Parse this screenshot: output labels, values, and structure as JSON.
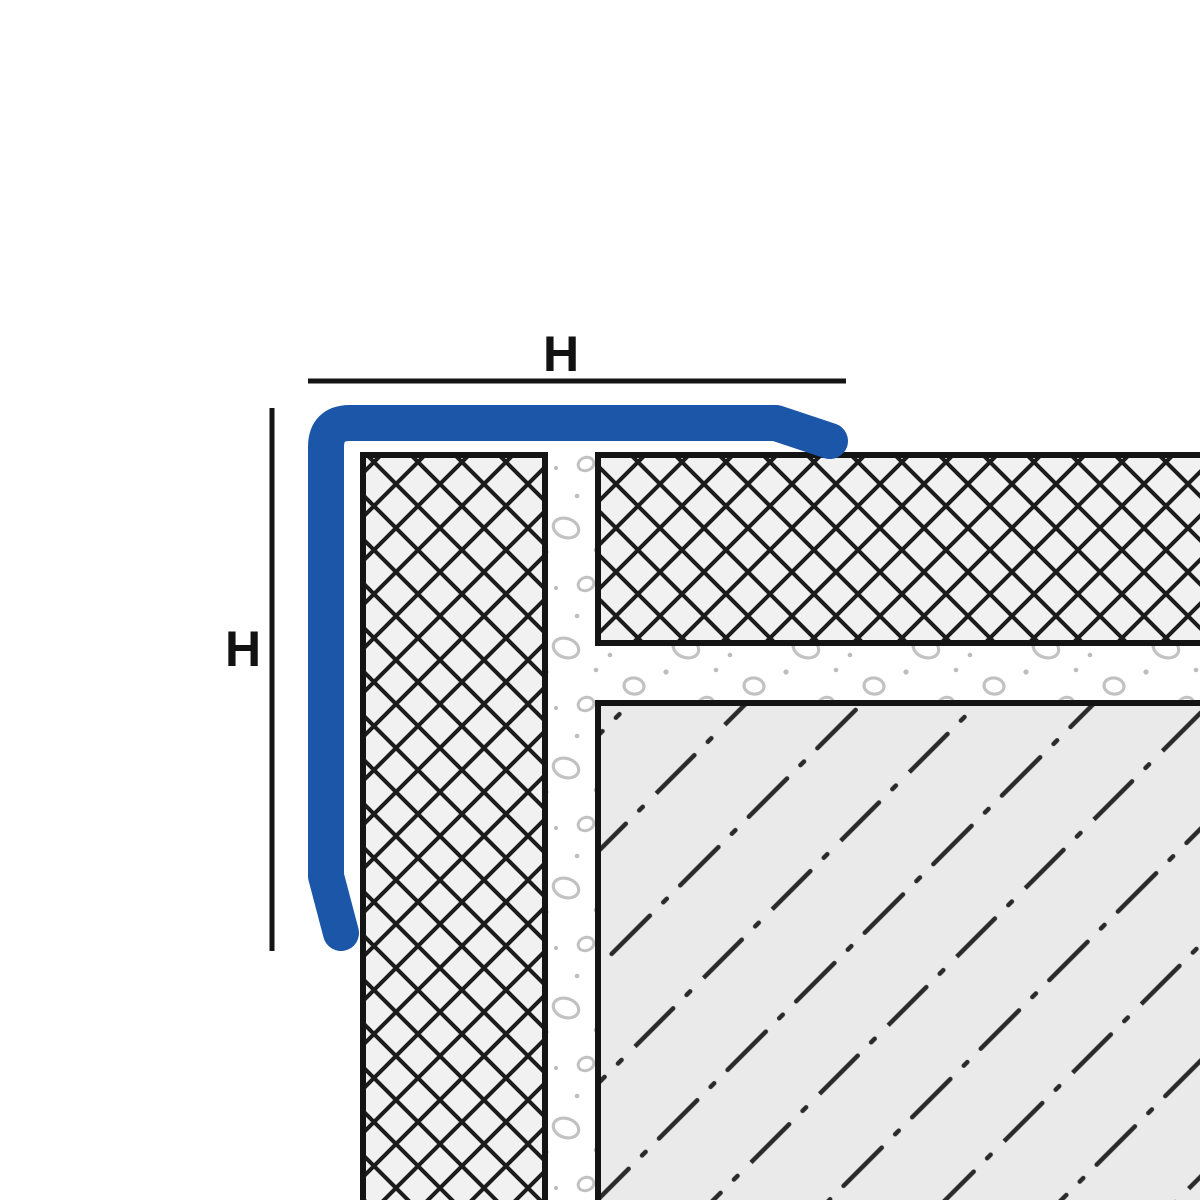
{
  "figure": {
    "type": "technical-cross-section",
    "dimension_labels": {
      "top": "H",
      "left": "H"
    }
  },
  "colors": {
    "background": "#ffffff",
    "profile_blue": "#1B56A9",
    "outline_black": "#141414",
    "hatch_black": "#1c1c1c",
    "tile_fill": "#f1f1f1",
    "substrate_fill": "#eaeaea",
    "substrate_hatch": "#2a2a2a",
    "mortar_fill": "#ffffff",
    "stipple_gray": "#c2c2c2"
  }
}
